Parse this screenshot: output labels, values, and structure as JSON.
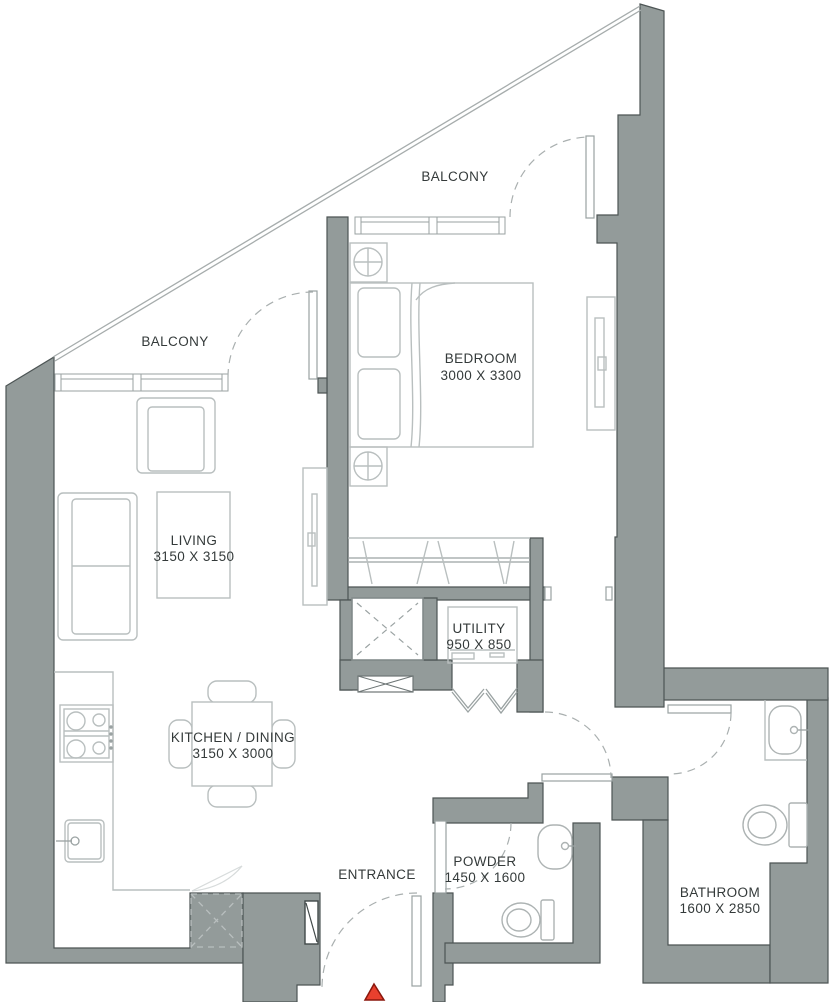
{
  "page": {
    "title": "Apartment Floor Plan"
  },
  "colors": {
    "wall": "#939b9a",
    "wall_edge": "#4d5555",
    "line_light": "#b9bfbf",
    "line_mid": "#9aa2a2",
    "door_arc": "#a9afaf",
    "text": "#343a3a",
    "entry_marker": "#e8402e",
    "entry_marker_edge": "#8a170d"
  },
  "labels": {
    "balcony_top": "BALCONY",
    "balcony_left": "BALCONY",
    "entrance": "ENTRANCE"
  },
  "rooms": {
    "bedroom": {
      "name": "BEDROOM",
      "dims": "3000 X 3300"
    },
    "living": {
      "name": "LIVING",
      "dims": "3150 X 3150"
    },
    "kitchen_dining": {
      "name": "KITCHEN / DINING",
      "dims": "3150 X 3000"
    },
    "utility": {
      "name": "UTILITY",
      "dims": "950 X 850"
    },
    "powder": {
      "name": "POWDER",
      "dims": "1450 X 1600"
    },
    "bathroom": {
      "name": "BATHROOM",
      "dims": "1600 X 2850"
    }
  }
}
